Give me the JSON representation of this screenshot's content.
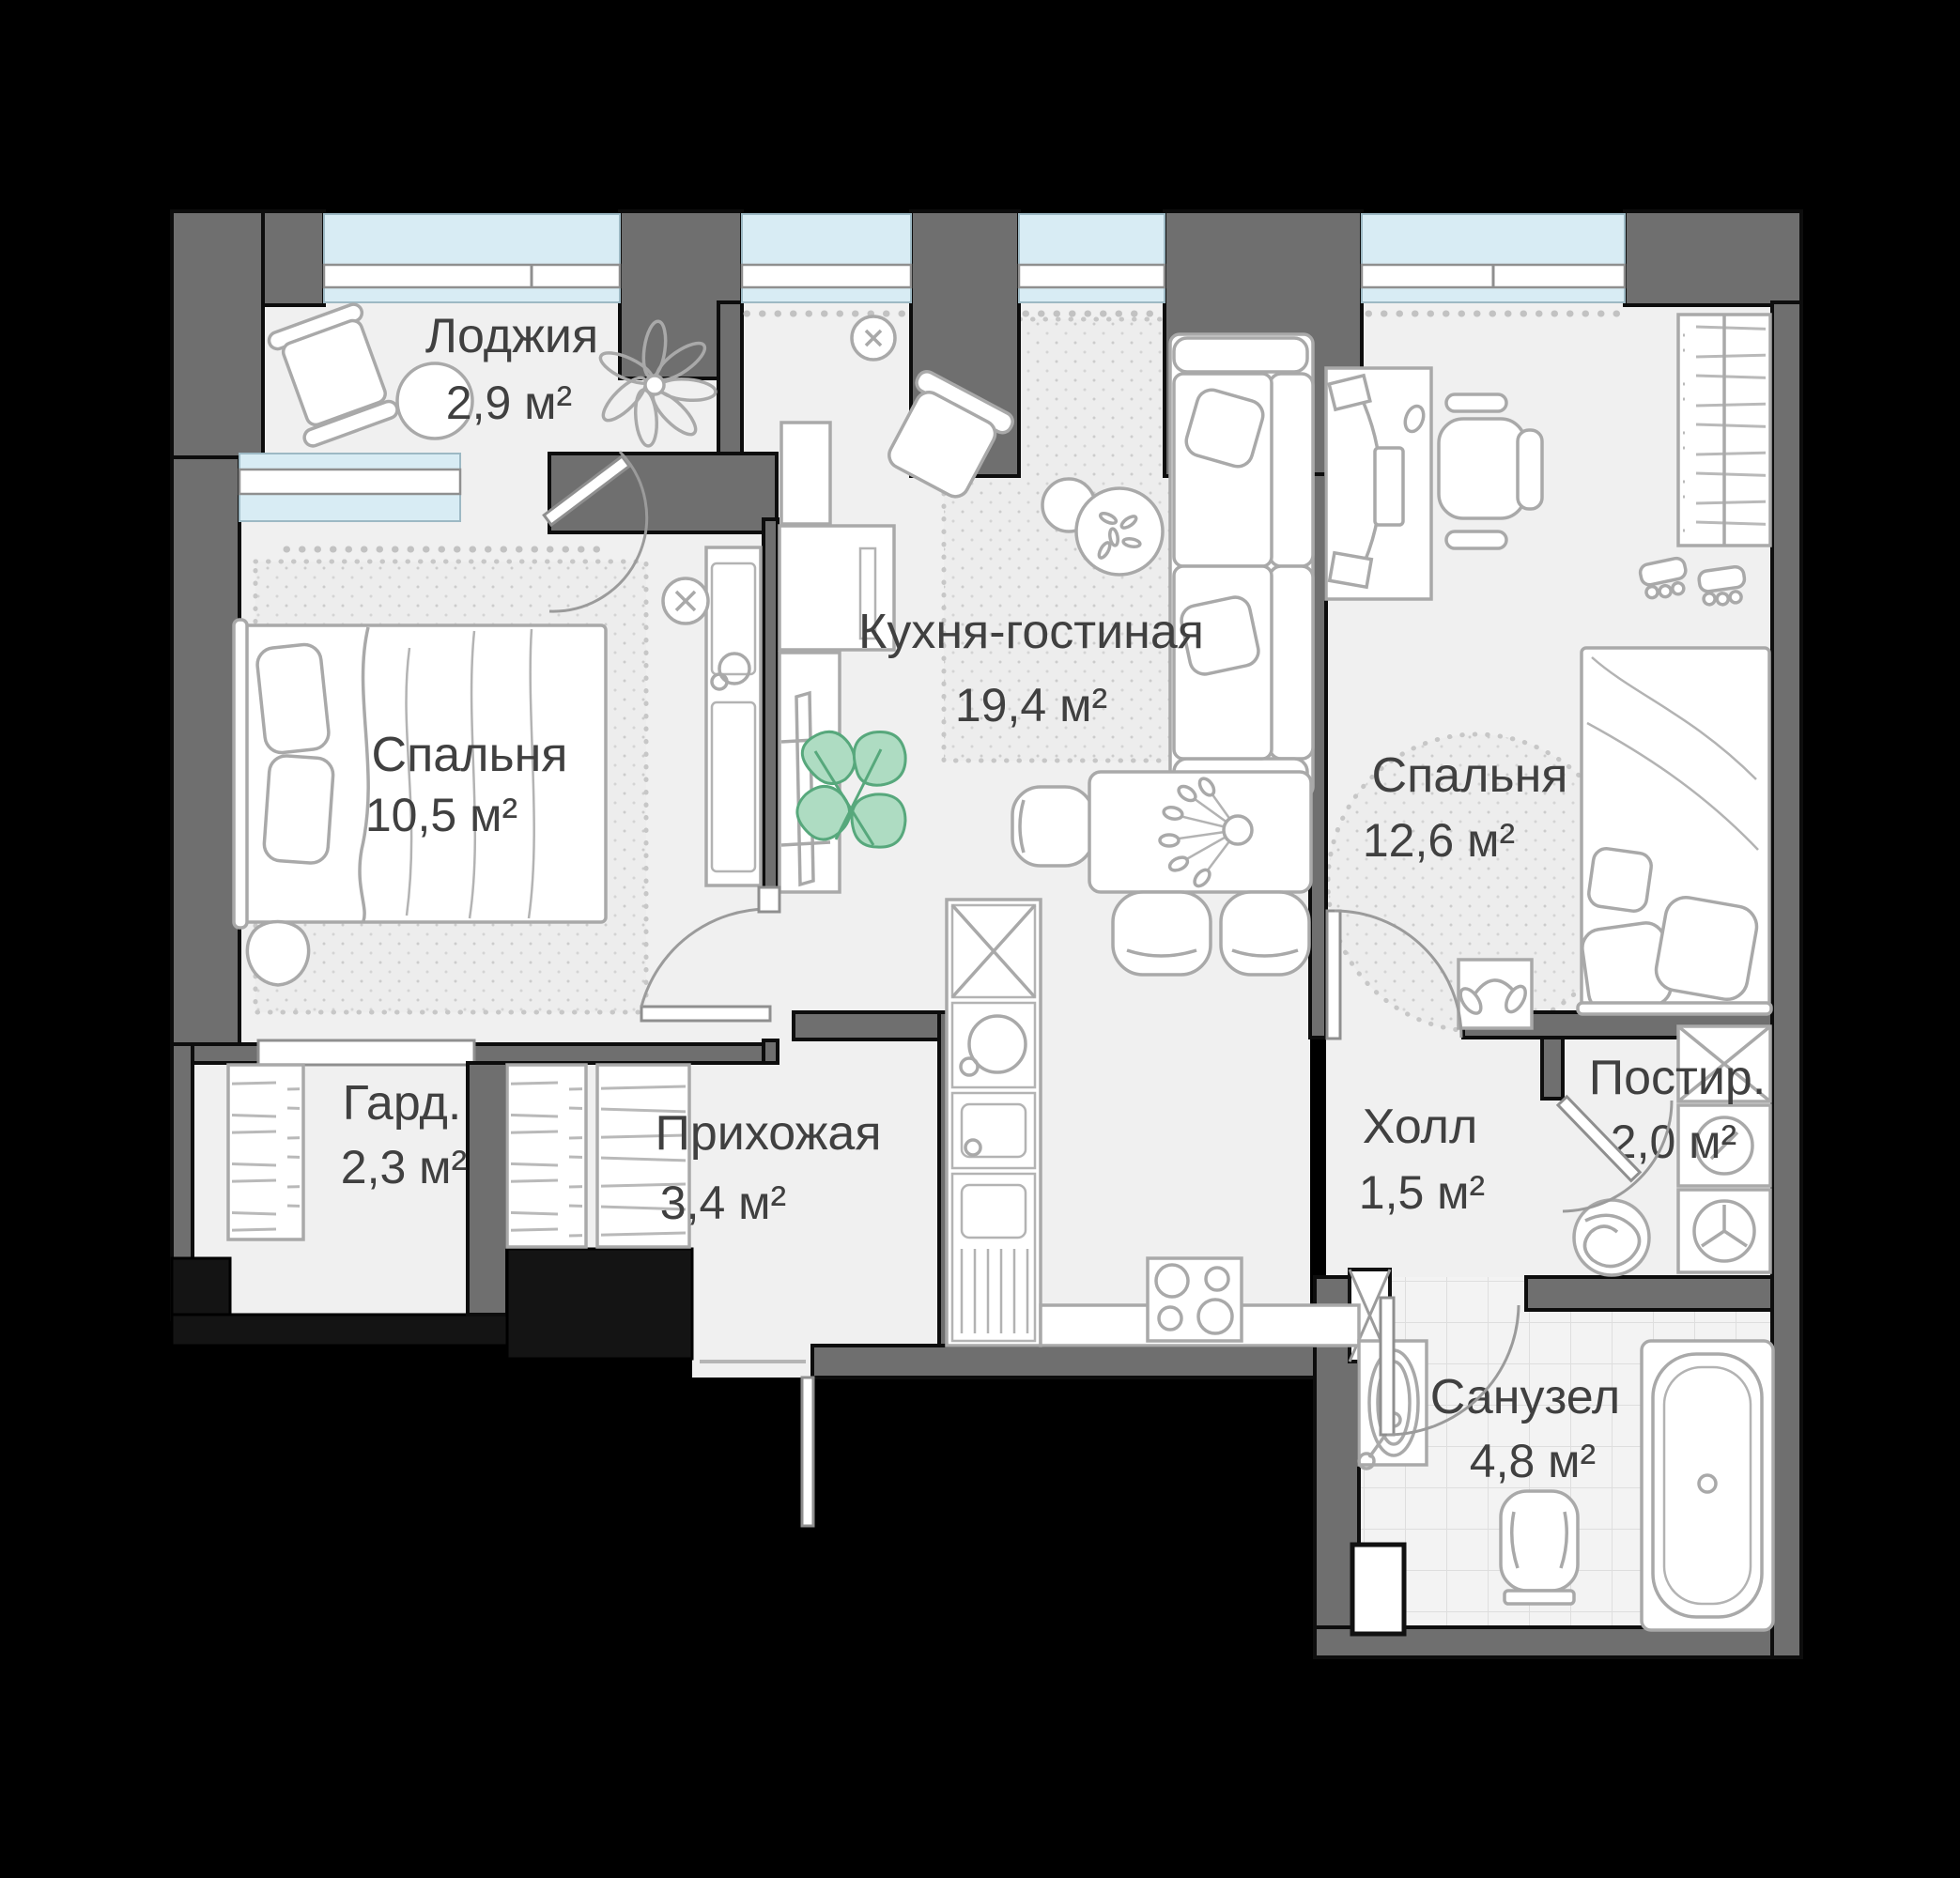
{
  "plan_title": "Floor plan of a 2-bedroom apartment",
  "rooms": [
    {
      "id": "loggia",
      "name": "Лоджия",
      "area": "2,9 м²"
    },
    {
      "id": "bedroom1",
      "name": "Спальня",
      "area": "10,5 м²"
    },
    {
      "id": "kitchen",
      "name": "Кухня-гостиная",
      "area": "19,4 м²"
    },
    {
      "id": "bedroom2",
      "name": "Спальня",
      "area": "12,6 м²"
    },
    {
      "id": "wardrobe",
      "name": "Гард.",
      "area": "2,3 м²"
    },
    {
      "id": "hallway",
      "name": "Прихожая",
      "area": "3,4 м²"
    },
    {
      "id": "hall",
      "name": "Холл",
      "area": "1,5 м²"
    },
    {
      "id": "laundry",
      "name": "Постир.",
      "area": "2,0 м²"
    },
    {
      "id": "bathroom",
      "name": "Санузел",
      "area": "4,8 м²"
    }
  ],
  "colors": {
    "background": "#000000",
    "wall": "#6f6f6f",
    "floor": "#f0f0f0",
    "window_glass": "#d8ecf4",
    "furniture_line": "#a9a9a9",
    "plant_green_fill": "#aedcc2",
    "plant_green_stroke": "#57a87c",
    "text": "#404040"
  }
}
